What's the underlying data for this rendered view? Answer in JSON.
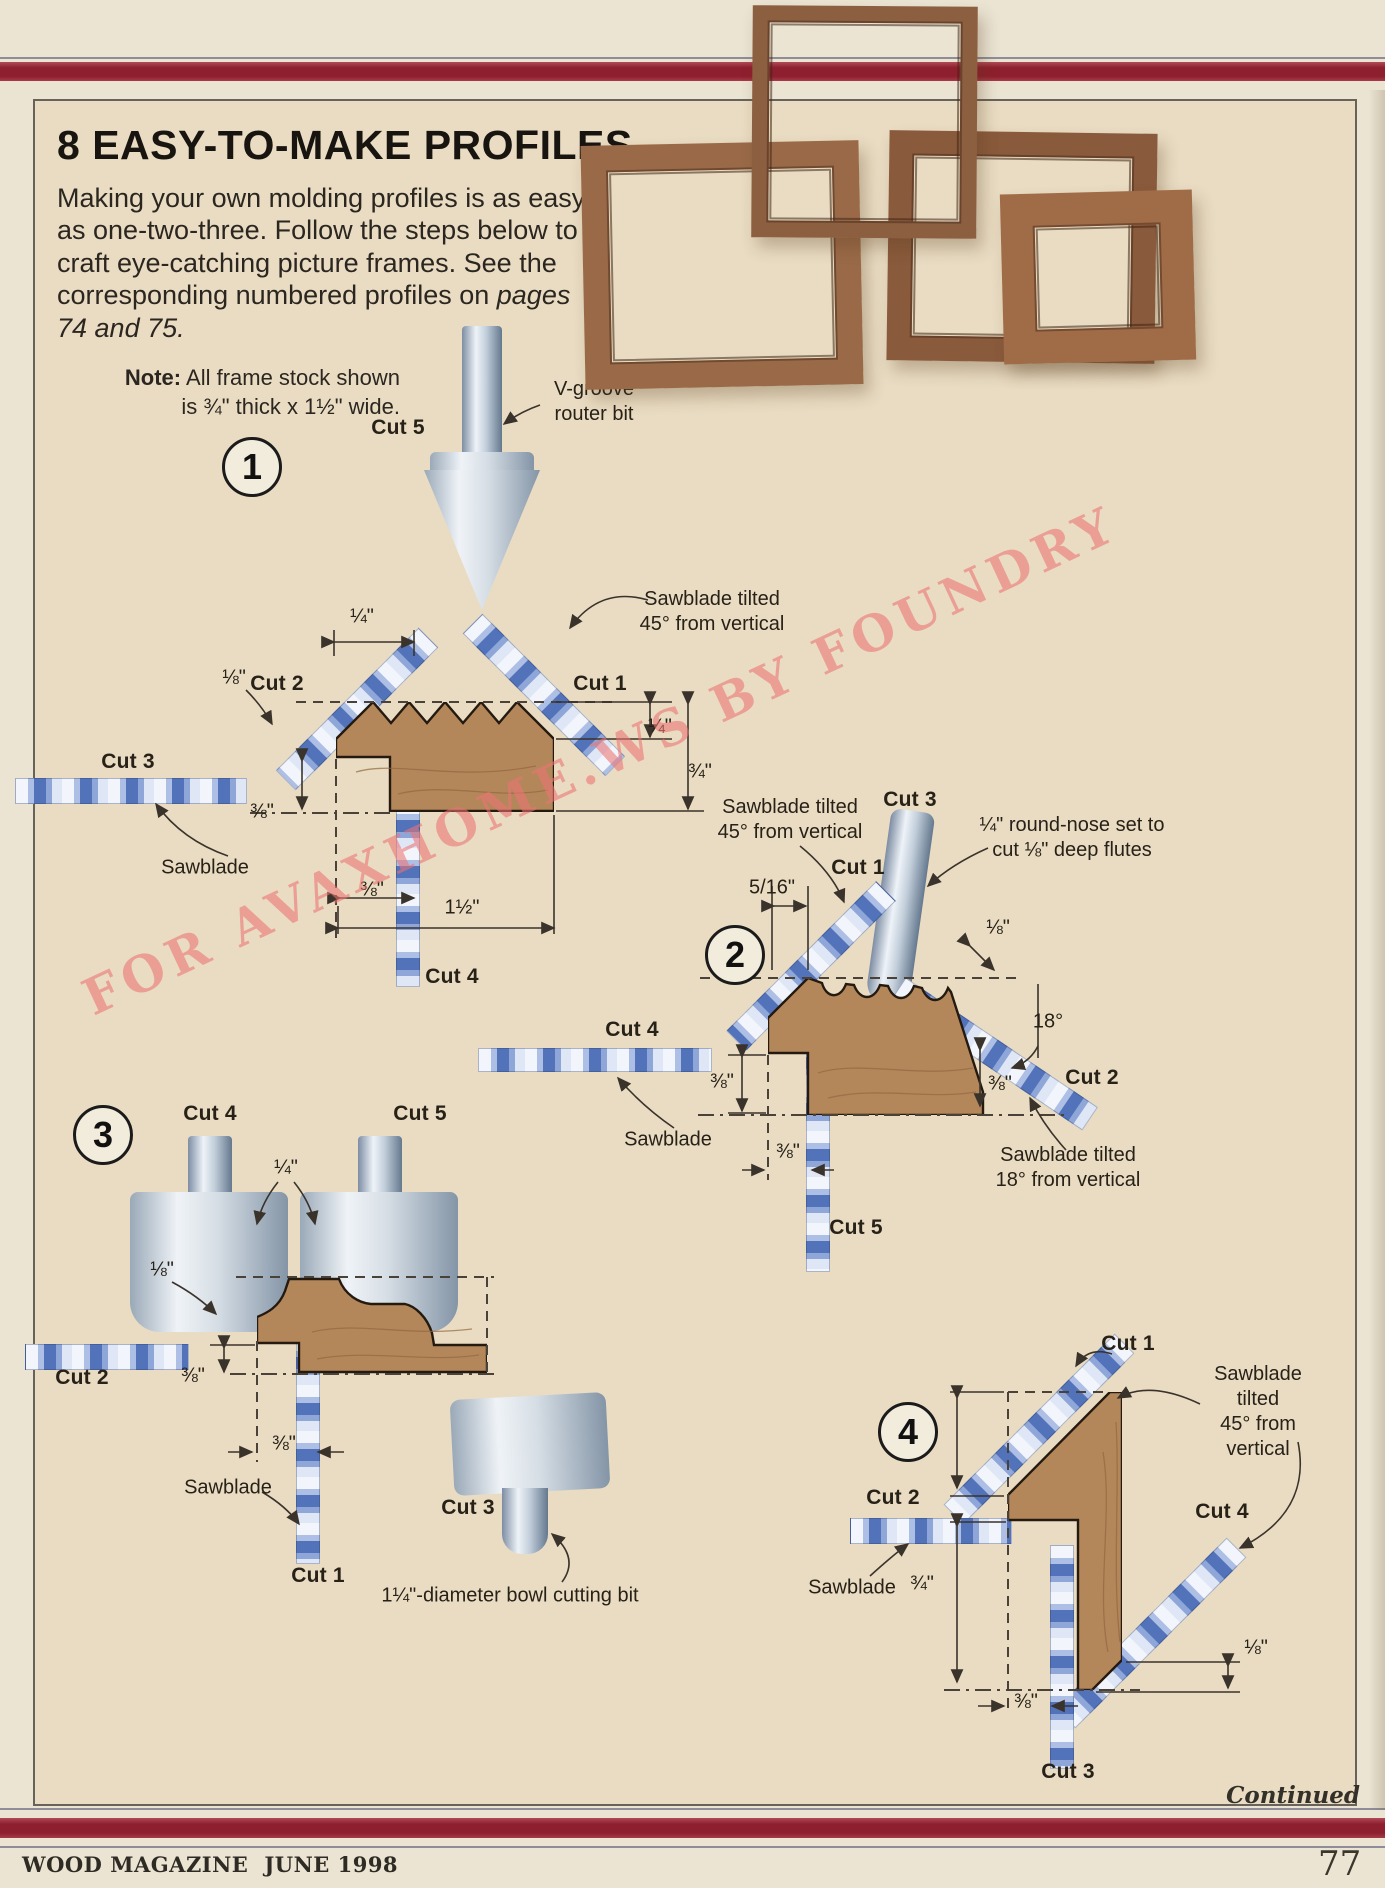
{
  "title": "8 EASY-TO-MAKE PROFILES",
  "intro": {
    "l1": "Making your own molding profiles is as easy",
    "l2": "as one-two-three. Follow the steps below to",
    "l3": "craft eye-catching picture frames. See the",
    "l4a": "corresponding numbered profiles on ",
    "l4b": "pages",
    "l5": "74 and 75."
  },
  "note": {
    "label": "Note:",
    "rest": " All frame stock shown",
    "line2": "is ¾\" thick x 1½\" wide."
  },
  "watermark": "FOR AVAXHOME.WS BY FOUNDRY",
  "footer": {
    "magazine": "WOOD MAGAZINE",
    "issue": "JUNE 1998",
    "page_number": "77",
    "continued": "Continued"
  },
  "colors": {
    "bar_red": "#8e1f2e",
    "cream": "#e9dcc2",
    "wood_profile": "#b4875b",
    "blade_blue": "#5272ba",
    "watermark_pink": "#ee7878"
  },
  "diagrams": {
    "d1": {
      "number": "1",
      "labels": [
        {
          "n": "cut-5-label",
          "t": "Cut 5",
          "x": 398,
          "y": 428,
          "b": true
        },
        {
          "n": "v-groove-bit-label",
          "t": "V-groove\nrouter bit",
          "x": 594,
          "y": 402
        },
        {
          "n": "sawblade-tilted-45-label",
          "t": "Sawblade tilted\n45° from vertical",
          "x": 712,
          "y": 612
        },
        {
          "n": "dim-quarter-top",
          "t": "¼\"",
          "x": 362,
          "y": 617
        },
        {
          "n": "cut-2-label",
          "t": "Cut 2",
          "x": 277,
          "y": 684,
          "b": true
        },
        {
          "n": "cut-1-label",
          "t": "Cut 1",
          "x": 600,
          "y": 684,
          "b": true
        },
        {
          "n": "dim-eighth",
          "t": "⅛\"",
          "x": 234,
          "y": 678
        },
        {
          "n": "cut-3-label",
          "t": "Cut 3",
          "x": 128,
          "y": 762,
          "b": true
        },
        {
          "n": "dim-three-eighths-left",
          "t": "⅜\"",
          "x": 262,
          "y": 812
        },
        {
          "n": "sawblade-label",
          "t": "Sawblade",
          "x": 205,
          "y": 868
        },
        {
          "n": "dim-quarter-right",
          "t": "¼\"",
          "x": 660,
          "y": 727
        },
        {
          "n": "dim-three-quarters-right",
          "t": "¾\"",
          "x": 700,
          "y": 772
        },
        {
          "n": "dim-three-eighths-bottom",
          "t": "⅜\"",
          "x": 372,
          "y": 890
        },
        {
          "n": "dim-one-and-half",
          "t": "1½\"",
          "x": 462,
          "y": 908
        },
        {
          "n": "cut-4-label",
          "t": "Cut 4",
          "x": 452,
          "y": 977,
          "b": true
        }
      ]
    },
    "d2": {
      "number": "2",
      "labels": [
        {
          "n": "sawblade-tilted-45-label",
          "t": "Sawblade tilted\n45° from vertical",
          "x": 790,
          "y": 820
        },
        {
          "n": "cut-3-label",
          "t": "Cut 3",
          "x": 910,
          "y": 800,
          "b": true
        },
        {
          "n": "round-nose-note",
          "t": "¼\" round-nose set to\ncut ⅛\" deep flutes",
          "x": 1072,
          "y": 838
        },
        {
          "n": "cut-1-label",
          "t": "Cut 1",
          "x": 858,
          "y": 868,
          "b": true
        },
        {
          "n": "dim-five-sixteenths",
          "t": "5/16\"",
          "x": 772,
          "y": 888
        },
        {
          "n": "dim-eighth",
          "t": "⅛\"",
          "x": 998,
          "y": 928
        },
        {
          "n": "dim-18-degrees",
          "t": "18°",
          "x": 1048,
          "y": 1022
        },
        {
          "n": "cut-2-label",
          "t": "Cut 2",
          "x": 1092,
          "y": 1078,
          "b": true
        },
        {
          "n": "dim-three-eighths-right",
          "t": "⅜\"",
          "x": 1000,
          "y": 1084
        },
        {
          "n": "sawblade-tilted-18-label",
          "t": "Sawblade tilted\n18° from vertical",
          "x": 1068,
          "y": 1168
        },
        {
          "n": "cut-4-label",
          "t": "Cut 4",
          "x": 632,
          "y": 1030,
          "b": true
        },
        {
          "n": "sawblade-label",
          "t": "Sawblade",
          "x": 668,
          "y": 1140
        },
        {
          "n": "dim-three-eighths-left",
          "t": "⅜\"",
          "x": 722,
          "y": 1082
        },
        {
          "n": "dim-three-eighths-bottom",
          "t": "⅜\"",
          "x": 788,
          "y": 1152
        },
        {
          "n": "cut-5-label",
          "t": "Cut 5",
          "x": 856,
          "y": 1228,
          "b": true
        }
      ]
    },
    "d3": {
      "number": "3",
      "labels": [
        {
          "n": "cut-4-label",
          "t": "Cut 4",
          "x": 210,
          "y": 1114,
          "b": true
        },
        {
          "n": "cut-5-label",
          "t": "Cut 5",
          "x": 420,
          "y": 1114,
          "b": true
        },
        {
          "n": "dim-quarter",
          "t": "¼\"",
          "x": 286,
          "y": 1168
        },
        {
          "n": "dim-eighth",
          "t": "⅛\"",
          "x": 162,
          "y": 1270
        },
        {
          "n": "cut-2-label",
          "t": "Cut 2",
          "x": 82,
          "y": 1378,
          "b": true
        },
        {
          "n": "dim-three-eighths-upper",
          "t": "⅜\"",
          "x": 193,
          "y": 1376
        },
        {
          "n": "dim-three-eighths-lower",
          "t": "⅜\"",
          "x": 284,
          "y": 1444
        },
        {
          "n": "sawblade-label",
          "t": "Sawblade",
          "x": 228,
          "y": 1488
        },
        {
          "n": "cut-1-label",
          "t": "Cut 1",
          "x": 318,
          "y": 1576,
          "b": true
        },
        {
          "n": "cut-3-label",
          "t": "Cut 3",
          "x": 468,
          "y": 1508,
          "b": true
        },
        {
          "n": "bowl-bit-note",
          "t": "1¼\"-diameter bowl cutting bit",
          "x": 510,
          "y": 1596
        }
      ]
    },
    "d4": {
      "number": "4",
      "labels": [
        {
          "n": "cut-1-label",
          "t": "Cut 1",
          "x": 1128,
          "y": 1344,
          "b": true
        },
        {
          "n": "sawblade-tilted-45-label",
          "t": "Sawblade tilted\n45° from vertical",
          "x": 1258,
          "y": 1412
        },
        {
          "n": "dim-five-eighths",
          "t": "⅝\"",
          "x": 922,
          "y": 1442
        },
        {
          "n": "cut-2-label",
          "t": "Cut 2",
          "x": 893,
          "y": 1498,
          "b": true
        },
        {
          "n": "sawblade-label",
          "t": "Sawblade",
          "x": 852,
          "y": 1588
        },
        {
          "n": "dim-three-quarters",
          "t": "¾\"",
          "x": 922,
          "y": 1584
        },
        {
          "n": "cut-4-label",
          "t": "Cut 4",
          "x": 1222,
          "y": 1512,
          "b": true
        },
        {
          "n": "dim-eighth",
          "t": "⅛\"",
          "x": 1256,
          "y": 1648
        },
        {
          "n": "dim-three-eighths",
          "t": "⅜\"",
          "x": 1026,
          "y": 1702
        },
        {
          "n": "cut-3-label",
          "t": "Cut 3",
          "x": 1068,
          "y": 1772,
          "b": true
        }
      ]
    }
  }
}
